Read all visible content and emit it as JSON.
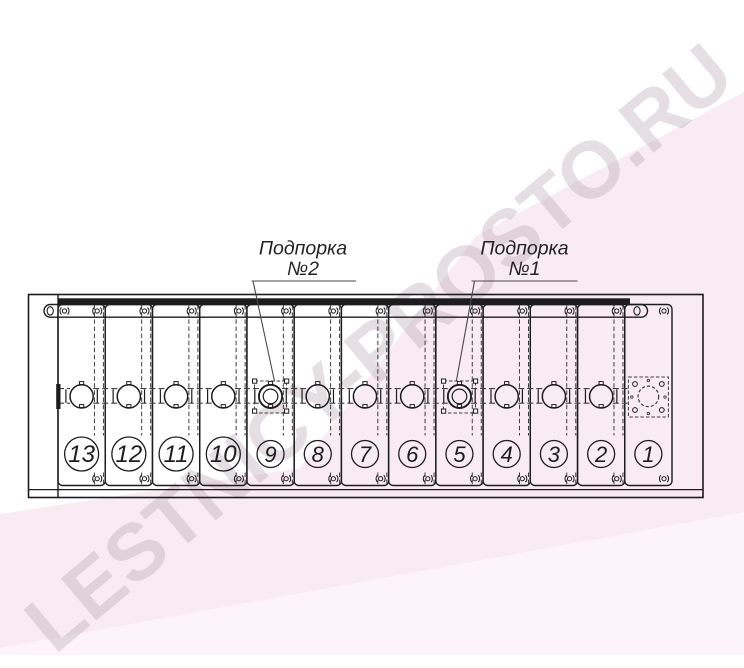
{
  "watermark": {
    "text": "LESTNICY-PROSTO.RU"
  },
  "callouts": [
    {
      "id": "support-2",
      "line1": "Подпорка",
      "line2": "№2",
      "target_step": "9"
    },
    {
      "id": "support-1",
      "line1": "Подпорка",
      "line2": "№1",
      "target_step": "5"
    }
  ],
  "steps": [
    {
      "number": "13"
    },
    {
      "number": "12"
    },
    {
      "number": "11"
    },
    {
      "number": "10"
    },
    {
      "number": "9",
      "support": true
    },
    {
      "number": "8"
    },
    {
      "number": "7"
    },
    {
      "number": "6"
    },
    {
      "number": "5",
      "support": true
    },
    {
      "number": "4"
    },
    {
      "number": "3"
    },
    {
      "number": "2"
    },
    {
      "number": "1",
      "end_plate": true
    }
  ],
  "icons": {
    "fastener": "fastener-icon",
    "bolt_end": "bolt-end-icon"
  },
  "colors": {
    "line": "#1d1d1d",
    "dashed": "#3f3f3f",
    "callout_line": "#4a4a4a",
    "facet_pink": "#f3dfe9",
    "facet_light": "#fdf6fa",
    "watermark": "#c3b2bc"
  }
}
